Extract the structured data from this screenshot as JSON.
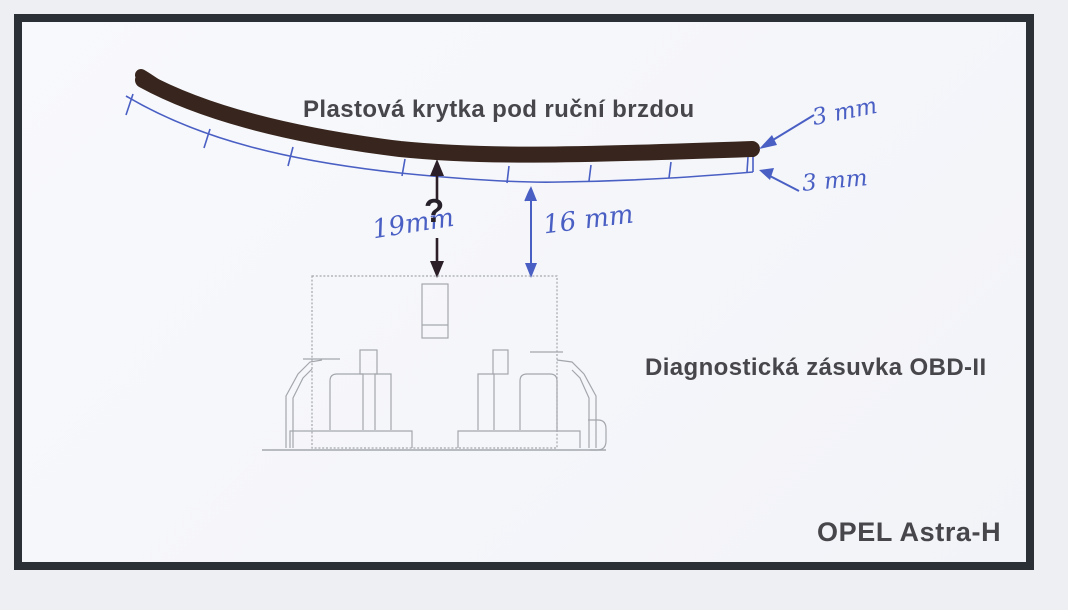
{
  "labels": {
    "cover_title": "Plastová krytka pod ruční brzdou",
    "socket_label": "Diagnostická zásuvka OBD-II",
    "car_model": "OPEL Astra-H"
  },
  "measurements": {
    "cover_thickness": "3 mm",
    "gap_under_cover": "3 mm",
    "unknown_distance": "19mm",
    "unknown_mark": "?",
    "known_distance": "16 mm"
  },
  "colors": {
    "frame_border": "#2b3036",
    "paper": "#f7f8fb",
    "outer_background": "#edeff3",
    "ink_blue": "#4a5fc4",
    "cover_dark_brown": "#38261e",
    "printed_text_gray": "#47474b",
    "drawing_gray": "#a3a7ad"
  }
}
